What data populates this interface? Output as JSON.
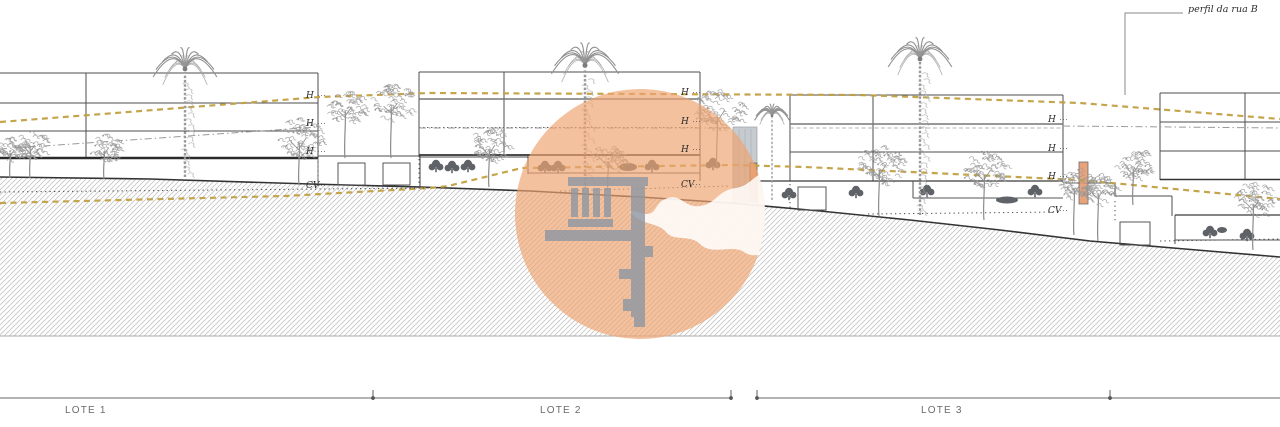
{
  "drawing": {
    "type": "architectural street elevation / section",
    "profile_annotation": "perfil da rua B",
    "height_marker": "H",
    "street_level_marker": "CV"
  },
  "lots": [
    {
      "label": "LOTE 1"
    },
    {
      "label": "LOTE 2"
    },
    {
      "label": "LOTE 3"
    }
  ],
  "level_marker_columns": [
    {
      "x": 306,
      "items": [
        {
          "text": "H",
          "y": 98
        },
        {
          "text": "H",
          "y": 126
        },
        {
          "text": "H",
          "y": 154
        },
        {
          "text": "CV",
          "y": 188
        }
      ]
    },
    {
      "x": 681,
      "items": [
        {
          "text": "H",
          "y": 95
        },
        {
          "text": "H",
          "y": 124
        },
        {
          "text": "H",
          "y": 152
        },
        {
          "text": "CV",
          "y": 187
        }
      ]
    },
    {
      "x": 1048,
      "items": [
        {
          "text": "H",
          "y": 122
        },
        {
          "text": "H",
          "y": 151
        },
        {
          "text": "H",
          "y": 179
        },
        {
          "text": "CV",
          "y": 213
        }
      ]
    }
  ],
  "colors": {
    "profile_dash_yellow": "#c2a041",
    "drawing_line": "#4d4d4d",
    "terrain_line": "#333333",
    "hatch": "#c6c6c6",
    "tree_gray": "#9b9b9b",
    "bush_dark": "#5f6368",
    "dimension_gray": "#b3b3b3",
    "watermark_circle": "#efa470",
    "watermark_logo_gray": "#8d97a3",
    "section_cut_salmon": "#e59a6d"
  }
}
